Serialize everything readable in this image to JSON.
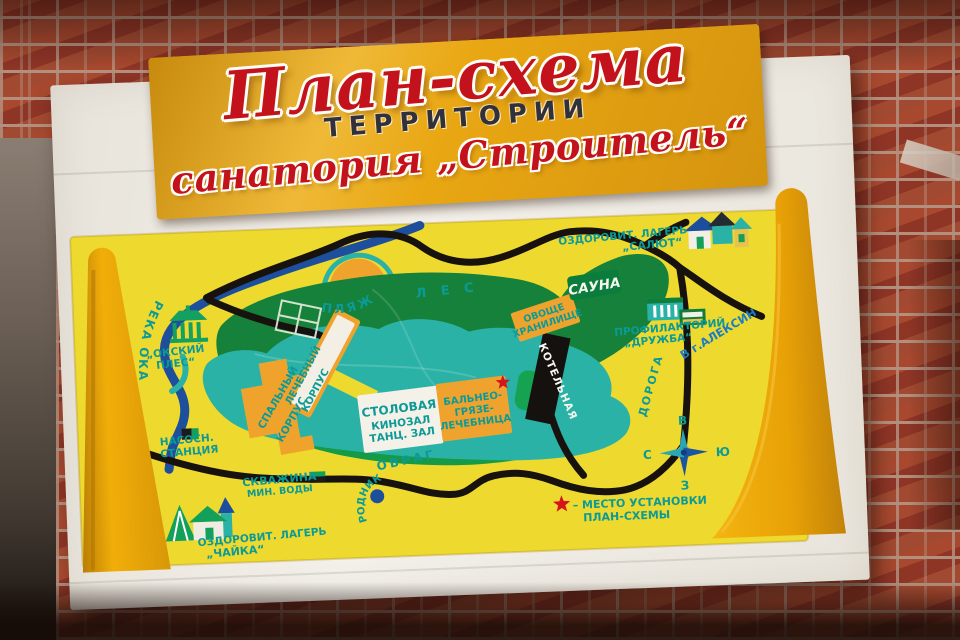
{
  "banner": {
    "title": "План-схема",
    "subtitle": "ТЕРРИТОРИИ",
    "subtitle2": "санатория „Строитель“",
    "colors": {
      "background": "#e9a713",
      "title_red": "#c3121b",
      "subtitle_dark": "#32313a"
    }
  },
  "map": {
    "colors": {
      "panel_yellow": "#eed92f",
      "forest_green": "#16813a",
      "grounds_teal": "#2bb2a6",
      "building_orange": "#f0a32c",
      "river_blue": "#1d4f9c",
      "road_black": "#17120e",
      "label_teal": "#0c9a97",
      "aleksin_blue": "#1a7ec2",
      "star_red": "#d5151c",
      "wedge_orange": "#eca50b",
      "boiler_black": "#14110e",
      "sauna_green": "#0a7c3c"
    },
    "labels": {
      "beach": "ПЛЯЖ",
      "river": "РЕКА ОКА",
      "okskiy_ples_1": "„ОКСКИЙ",
      "okskiy_ples_2": "ПЛЕС“",
      "forest": "Л Е С",
      "sauna": "САУНА",
      "vegetable_store_1": "ОВОЩЕ",
      "vegetable_store_2": "ХРАНИЛИЩЕ",
      "camp_salut_1": "ОЗДОРОВИТ. ЛАГЕРЬ",
      "camp_salut_2": "„САЛЮТ“",
      "profilaktoriy_1": "ПРОФИЛАКТОРИЙ",
      "profilaktoriy_2": "„ДРУЖБА“",
      "to_aleksin": "В г.АЛЕКСИН",
      "road": "ДОРОГА",
      "sleeping_block_1": "СПАЛЬНЫЙ",
      "sleeping_block_2": "КОРПУС",
      "medical_block_1": "ЛЕЧЕБНЫЙ",
      "medical_block_2": "КОРПУС",
      "dining_1": "СТОЛОВАЯ",
      "dining_2": "КИНОЗАЛ",
      "dining_3": "ТАНЦ. ЗАЛ",
      "balneo_1": "БАЛЬНЕО-",
      "balneo_2": "ГРЯЗЕ-",
      "balneo_3": "ЛЕЧЕБНИЦА",
      "boiler_house": "КОТЕЛЬНАЯ",
      "pump_station_1": "НАСОСН.",
      "pump_station_2": "СТАНЦИЯ",
      "mineral_well_1": "СКВАЖИНА",
      "mineral_well_2": "МИН. ВОДЫ",
      "ravine": "ОВРАГ",
      "spring": "РОДНИК",
      "camp_chaika_1": "ОЗДОРОВИТ. ЛАГЕРЬ",
      "camp_chaika_2": "„ЧАЙКА“"
    },
    "compass": {
      "top": "В",
      "left": "С",
      "right": "Ю",
      "bottom": "З"
    },
    "legend": {
      "line1": "– МЕСТО УСТАНОВКИ",
      "line2": "ПЛАН-СХЕМЫ"
    },
    "icons": {
      "gazebo": "gazebo-icon",
      "beach": "beach-semicircle-icon",
      "pump": "pump-station-icon",
      "well": "mineral-well-icon",
      "spring": "spring-dot-icon",
      "map_star": "red-star-icon",
      "legend_star": "red-star-icon",
      "compass": "compass-rose-icon",
      "salut_houses": "camp-houses-icons",
      "druzhba_buildings": "striped-building-icons",
      "chaika": "tent-house-tower-icons"
    }
  }
}
